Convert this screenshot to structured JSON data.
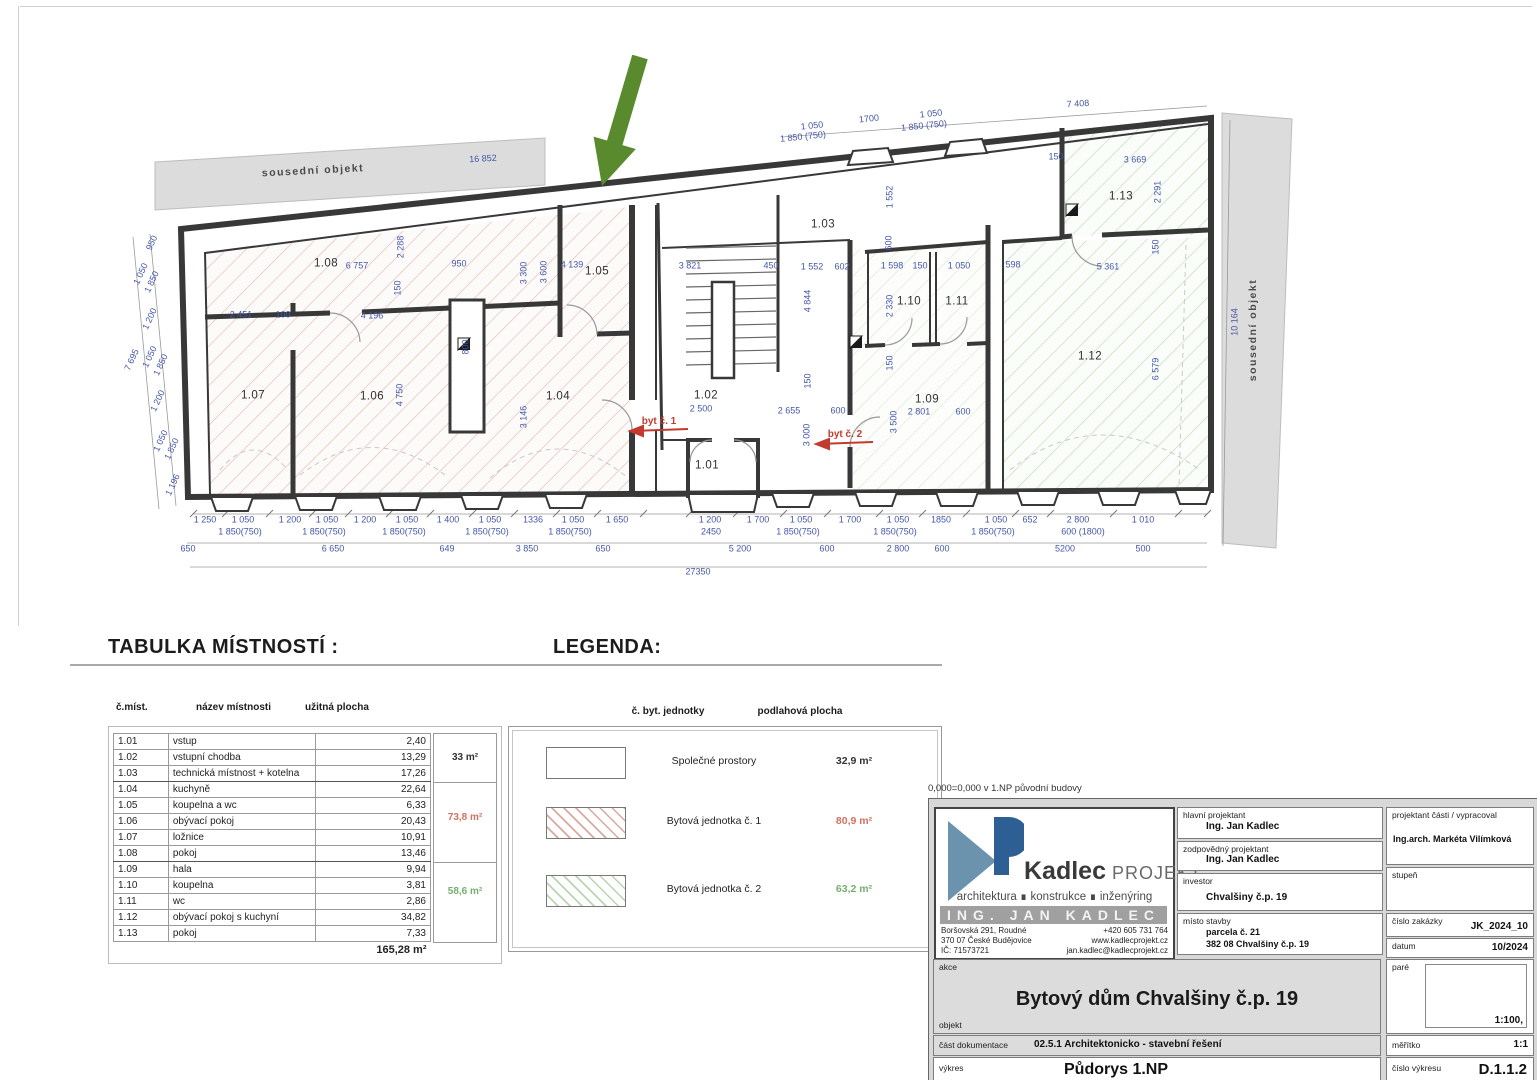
{
  "headings": {
    "table": "TABULKA MÍSTNOSTÍ :",
    "legend": "LEGENDA:"
  },
  "table": {
    "headers": {
      "id": "č.míst.",
      "name": "název místnosti",
      "area": "užitná plocha"
    },
    "rows": [
      {
        "id": "1.01",
        "name": "vstup",
        "area": "2,40"
      },
      {
        "id": "1.02",
        "name": "vstupní chodba",
        "area": "13,29"
      },
      {
        "id": "1.03",
        "name": "technická místnost + kotelna",
        "area": "17,26"
      },
      {
        "id": "1.04",
        "name": "kuchyně",
        "area": "22,64"
      },
      {
        "id": "1.05",
        "name": "koupelna a wc",
        "area": "6,33"
      },
      {
        "id": "1.06",
        "name": "obývací pokoj",
        "area": "20,43"
      },
      {
        "id": "1.07",
        "name": "ložnice",
        "area": "10,91"
      },
      {
        "id": "1.08",
        "name": "pokoj",
        "area": "13,46"
      },
      {
        "id": "1.09",
        "name": "hala",
        "area": "9,94"
      },
      {
        "id": "1.10",
        "name": "koupelna",
        "area": "3,81"
      },
      {
        "id": "1.11",
        "name": "wc",
        "area": "2,86"
      },
      {
        "id": "1.12",
        "name": "obývací pokoj s kuchyní",
        "area": "34,82"
      },
      {
        "id": "1.13",
        "name": "pokoj",
        "area": "7,33"
      }
    ],
    "total": "165,28 m²",
    "groups": [
      {
        "value": "33 m²",
        "color": "#333333"
      },
      {
        "value": "73,8 m²",
        "color": "#d4705f"
      },
      {
        "value": "58,6 m²",
        "color": "#74b06c"
      }
    ]
  },
  "legend": {
    "headers": {
      "unit": "č. byt. jednotky",
      "area": "podlahová plocha"
    },
    "rows": [
      {
        "name": "Společné prostory",
        "area": "32,9 m²",
        "color": "#333333"
      },
      {
        "name": "Bytová jednotka č. 1",
        "area": "80,9 m²",
        "color": "#d4705f"
      },
      {
        "name": "Bytová jednotka č. 2",
        "area": "63,2 m²",
        "color": "#74b06c"
      }
    ]
  },
  "titleblock": {
    "note": "0,000=0,000 v 1.NP původní budovy",
    "logo": {
      "name": "Kadlec",
      "suffix": "PROJEKT",
      "tagline": "architektura  ∎  konstrukce  ∎  inženýring",
      "banner": "ING. JAN KADLEC",
      "address_1": "Boršovská 291, Roudné",
      "address_2": "370 07 České Budějovice",
      "address_3": "IČ:   71573721",
      "contact_1": "+420 605 731 764",
      "contact_2": "www.kadlecprojekt.cz",
      "contact_3": "jan.kadlec@kadlecprojekt.cz"
    },
    "fields": {
      "hlavni_label": "hlavní projektant",
      "hlavni_value": "Ing. Jan Kadlec",
      "zodp_label": "zodpovědný projektant",
      "zodp_value": "Ing. Jan Kadlec",
      "proj_label": "projektant části / vypracoval",
      "proj_value": "Ing.arch. Markéta Vilímková",
      "investor_label": "investor",
      "investor_value": "Chvalšiny č.p. 19",
      "stupen_label": "stupeň",
      "misto_label": "místo stavby",
      "misto_value_1": "parcela č. 21",
      "misto_value_2": "382 08 Chvalšiny č.p. 19",
      "zakazka_label": "číslo zakázky",
      "zakazka_value": "JK_2024_10",
      "datum_label": "datum",
      "datum_value": "10/2024",
      "pare_label": "paré",
      "pare_scale": "1:100,",
      "akce_label": "akce",
      "akce_value": "Bytový dům Chvalšiny č.p. 19",
      "objekt_label": "objekt",
      "dok_label": "část dokumentace",
      "dok_value": "02.5.1   Architektonicko - stavební řešení",
      "vykres_label": "výkres",
      "vykres_value": "Půdorys 1.NP",
      "meritko_label": "měřítko",
      "meritko_value": "1:1",
      "cislo_label": "číslo výkresu",
      "cislo_value": "D.1.1.2"
    }
  },
  "plan": {
    "labels": [
      {
        "t": "sousední objekt",
        "x": 313,
        "y": 171,
        "r": -3,
        "c": "band"
      },
      {
        "t": "16 852",
        "x": 483,
        "y": 159,
        "r": -3
      },
      {
        "t": "sousední objekt",
        "x": 1253,
        "y": 330,
        "r": -90,
        "c": "band"
      },
      {
        "t": "10 164",
        "x": 1235,
        "y": 322,
        "r": -90
      },
      {
        "t": "1 050",
        "x": 812,
        "y": 126,
        "r": -6
      },
      {
        "t": "1 850 (750)",
        "x": 803,
        "y": 137,
        "r": -6
      },
      {
        "t": "1700",
        "x": 869,
        "y": 119,
        "r": -6
      },
      {
        "t": "1 050",
        "x": 931,
        "y": 114,
        "r": -6
      },
      {
        "t": "1 850 (750)",
        "x": 924,
        "y": 126,
        "r": -6
      },
      {
        "t": "7 408",
        "x": 1078,
        "y": 104,
        "r": -3
      },
      {
        "t": "950",
        "x": 152,
        "y": 243,
        "r": -65
      },
      {
        "t": "1 050",
        "x": 141,
        "y": 274,
        "r": -65
      },
      {
        "t": "1 850",
        "x": 152,
        "y": 282,
        "r": -65
      },
      {
        "t": "1 200",
        "x": 150,
        "y": 319,
        "r": -65
      },
      {
        "t": "1 050",
        "x": 150,
        "y": 357,
        "r": -65
      },
      {
        "t": "1 850",
        "x": 161,
        "y": 365,
        "r": -65
      },
      {
        "t": "1 200",
        "x": 158,
        "y": 401,
        "r": -65
      },
      {
        "t": "1 050",
        "x": 161,
        "y": 441,
        "r": -65
      },
      {
        "t": "1 850",
        "x": 172,
        "y": 449,
        "r": -65
      },
      {
        "t": "1 196",
        "x": 173,
        "y": 485,
        "r": -65
      },
      {
        "t": "7 695",
        "x": 132,
        "y": 360,
        "r": -65
      },
      {
        "t": "1.01",
        "x": 707,
        "y": 466,
        "c": "room"
      },
      {
        "t": "1.02",
        "x": 706,
        "y": 396,
        "c": "room"
      },
      {
        "t": "1.03",
        "x": 823,
        "y": 225,
        "c": "room"
      },
      {
        "t": "1.04",
        "x": 558,
        "y": 397,
        "c": "room"
      },
      {
        "t": "1.05",
        "x": 597,
        "y": 272,
        "c": "room"
      },
      {
        "t": "1.06",
        "x": 372,
        "y": 397,
        "c": "room"
      },
      {
        "t": "1.07",
        "x": 253,
        "y": 396,
        "c": "room"
      },
      {
        "t": "1.08",
        "x": 326,
        "y": 264,
        "c": "room"
      },
      {
        "t": "1.09",
        "x": 927,
        "y": 400,
        "c": "room"
      },
      {
        "t": "1.10",
        "x": 909,
        "y": 302,
        "c": "room"
      },
      {
        "t": "1.11",
        "x": 957,
        "y": 302,
        "c": "room"
      },
      {
        "t": "1.12",
        "x": 1090,
        "y": 357,
        "c": "room"
      },
      {
        "t": "1.13",
        "x": 1121,
        "y": 197,
        "c": "room"
      },
      {
        "t": "byt č. 1",
        "x": 659,
        "y": 422,
        "c": "red"
      },
      {
        "t": "byt č. 2",
        "x": 845,
        "y": 435,
        "c": "red"
      },
      {
        "t": "6 757",
        "x": 357,
        "y": 266
      },
      {
        "t": "2 288",
        "x": 401,
        "y": 247,
        "r": -90
      },
      {
        "t": "150",
        "x": 398,
        "y": 288,
        "r": -90
      },
      {
        "t": "950",
        "x": 459,
        "y": 264
      },
      {
        "t": "3 300",
        "x": 524,
        "y": 273,
        "r": -90
      },
      {
        "t": "3 600",
        "x": 544,
        "y": 272,
        "r": -90
      },
      {
        "t": "4 139",
        "x": 572,
        "y": 265
      },
      {
        "t": "2 451",
        "x": 241,
        "y": 315
      },
      {
        "t": "100",
        "x": 283,
        "y": 315
      },
      {
        "t": "4 196",
        "x": 372,
        "y": 316
      },
      {
        "t": "800",
        "x": 466,
        "y": 347,
        "r": -90
      },
      {
        "t": "4 750",
        "x": 400,
        "y": 395,
        "r": -90
      },
      {
        "t": "3 146",
        "x": 524,
        "y": 417,
        "r": -90
      },
      {
        "t": "3 821",
        "x": 690,
        "y": 266
      },
      {
        "t": "450",
        "x": 771,
        "y": 266
      },
      {
        "t": "1 552",
        "x": 812,
        "y": 267
      },
      {
        "t": "602",
        "x": 842,
        "y": 267
      },
      {
        "t": "1 598",
        "x": 892,
        "y": 266
      },
      {
        "t": "150",
        "x": 920,
        "y": 266
      },
      {
        "t": "1 050",
        "x": 959,
        "y": 266
      },
      {
        "t": "598",
        "x": 1013,
        "y": 265
      },
      {
        "t": "1 552",
        "x": 890,
        "y": 197,
        "r": -90
      },
      {
        "t": "600",
        "x": 889,
        "y": 243,
        "r": -90
      },
      {
        "t": "4 844",
        "x": 808,
        "y": 301,
        "r": -90
      },
      {
        "t": "2 330",
        "x": 890,
        "y": 306,
        "r": -90
      },
      {
        "t": "150",
        "x": 808,
        "y": 381,
        "r": -90
      },
      {
        "t": "150",
        "x": 890,
        "y": 363,
        "r": -90
      },
      {
        "t": "2 500",
        "x": 701,
        "y": 409
      },
      {
        "t": "2 655",
        "x": 789,
        "y": 411
      },
      {
        "t": "600",
        "x": 838,
        "y": 411
      },
      {
        "t": "2 801",
        "x": 919,
        "y": 412
      },
      {
        "t": "600",
        "x": 963,
        "y": 412
      },
      {
        "t": "3 000",
        "x": 807,
        "y": 435,
        "r": -90
      },
      {
        "t": "3 500",
        "x": 894,
        "y": 422,
        "r": -90
      },
      {
        "t": "5 361",
        "x": 1108,
        "y": 267
      },
      {
        "t": "2 291",
        "x": 1158,
        "y": 192,
        "r": -90
      },
      {
        "t": "3 669",
        "x": 1135,
        "y": 160
      },
      {
        "t": "150",
        "x": 1056,
        "y": 157
      },
      {
        "t": "150",
        "x": 1156,
        "y": 247,
        "r": -90
      },
      {
        "t": "6 579",
        "x": 1156,
        "y": 369,
        "r": -90
      },
      {
        "t": "1 250",
        "x": 205,
        "y": 520
      },
      {
        "t": "1 050",
        "x": 243,
        "y": 520
      },
      {
        "t": "1 200",
        "x": 290,
        "y": 520
      },
      {
        "t": "1 050",
        "x": 327,
        "y": 520
      },
      {
        "t": "1 200",
        "x": 365,
        "y": 520
      },
      {
        "t": "1 050",
        "x": 407,
        "y": 520
      },
      {
        "t": "1 400",
        "x": 448,
        "y": 520
      },
      {
        "t": "1 050",
        "x": 490,
        "y": 520
      },
      {
        "t": "1336",
        "x": 533,
        "y": 520
      },
      {
        "t": "1 050",
        "x": 573,
        "y": 520
      },
      {
        "t": "1 650",
        "x": 617,
        "y": 520
      },
      {
        "t": "1 200",
        "x": 710,
        "y": 520
      },
      {
        "t": "1 700",
        "x": 758,
        "y": 520
      },
      {
        "t": "1 050",
        "x": 801,
        "y": 520
      },
      {
        "t": "1 700",
        "x": 850,
        "y": 520
      },
      {
        "t": "1 050",
        "x": 898,
        "y": 520
      },
      {
        "t": "1850",
        "x": 941,
        "y": 520
      },
      {
        "t": "1 050",
        "x": 996,
        "y": 520
      },
      {
        "t": "652",
        "x": 1030,
        "y": 520
      },
      {
        "t": "2 800",
        "x": 1078,
        "y": 520
      },
      {
        "t": "1 010",
        "x": 1143,
        "y": 520
      },
      {
        "t": "1 850(750)",
        "x": 240,
        "y": 532
      },
      {
        "t": "1 850(750)",
        "x": 324,
        "y": 532
      },
      {
        "t": "1 850(750)",
        "x": 404,
        "y": 532
      },
      {
        "t": "1 850(750)",
        "x": 487,
        "y": 532
      },
      {
        "t": "1 850(750)",
        "x": 570,
        "y": 532
      },
      {
        "t": "2450",
        "x": 711,
        "y": 532
      },
      {
        "t": "1 850(750)",
        "x": 798,
        "y": 532
      },
      {
        "t": "1 850(750)",
        "x": 895,
        "y": 532
      },
      {
        "t": "1 850(750)",
        "x": 993,
        "y": 532
      },
      {
        "t": "600 (1800)",
        "x": 1083,
        "y": 532
      },
      {
        "t": "650",
        "x": 188,
        "y": 549
      },
      {
        "t": "6 650",
        "x": 333,
        "y": 549
      },
      {
        "t": "649",
        "x": 447,
        "y": 549
      },
      {
        "t": "3 850",
        "x": 527,
        "y": 549
      },
      {
        "t": "650",
        "x": 603,
        "y": 549
      },
      {
        "t": "5 200",
        "x": 740,
        "y": 549
      },
      {
        "t": "600",
        "x": 827,
        "y": 549
      },
      {
        "t": "2 800",
        "x": 898,
        "y": 549
      },
      {
        "t": "600",
        "x": 942,
        "y": 549
      },
      {
        "t": "5200",
        "x": 1065,
        "y": 549
      },
      {
        "t": "500",
        "x": 1143,
        "y": 549
      },
      {
        "t": "27350",
        "x": 698,
        "y": 572
      }
    ]
  }
}
